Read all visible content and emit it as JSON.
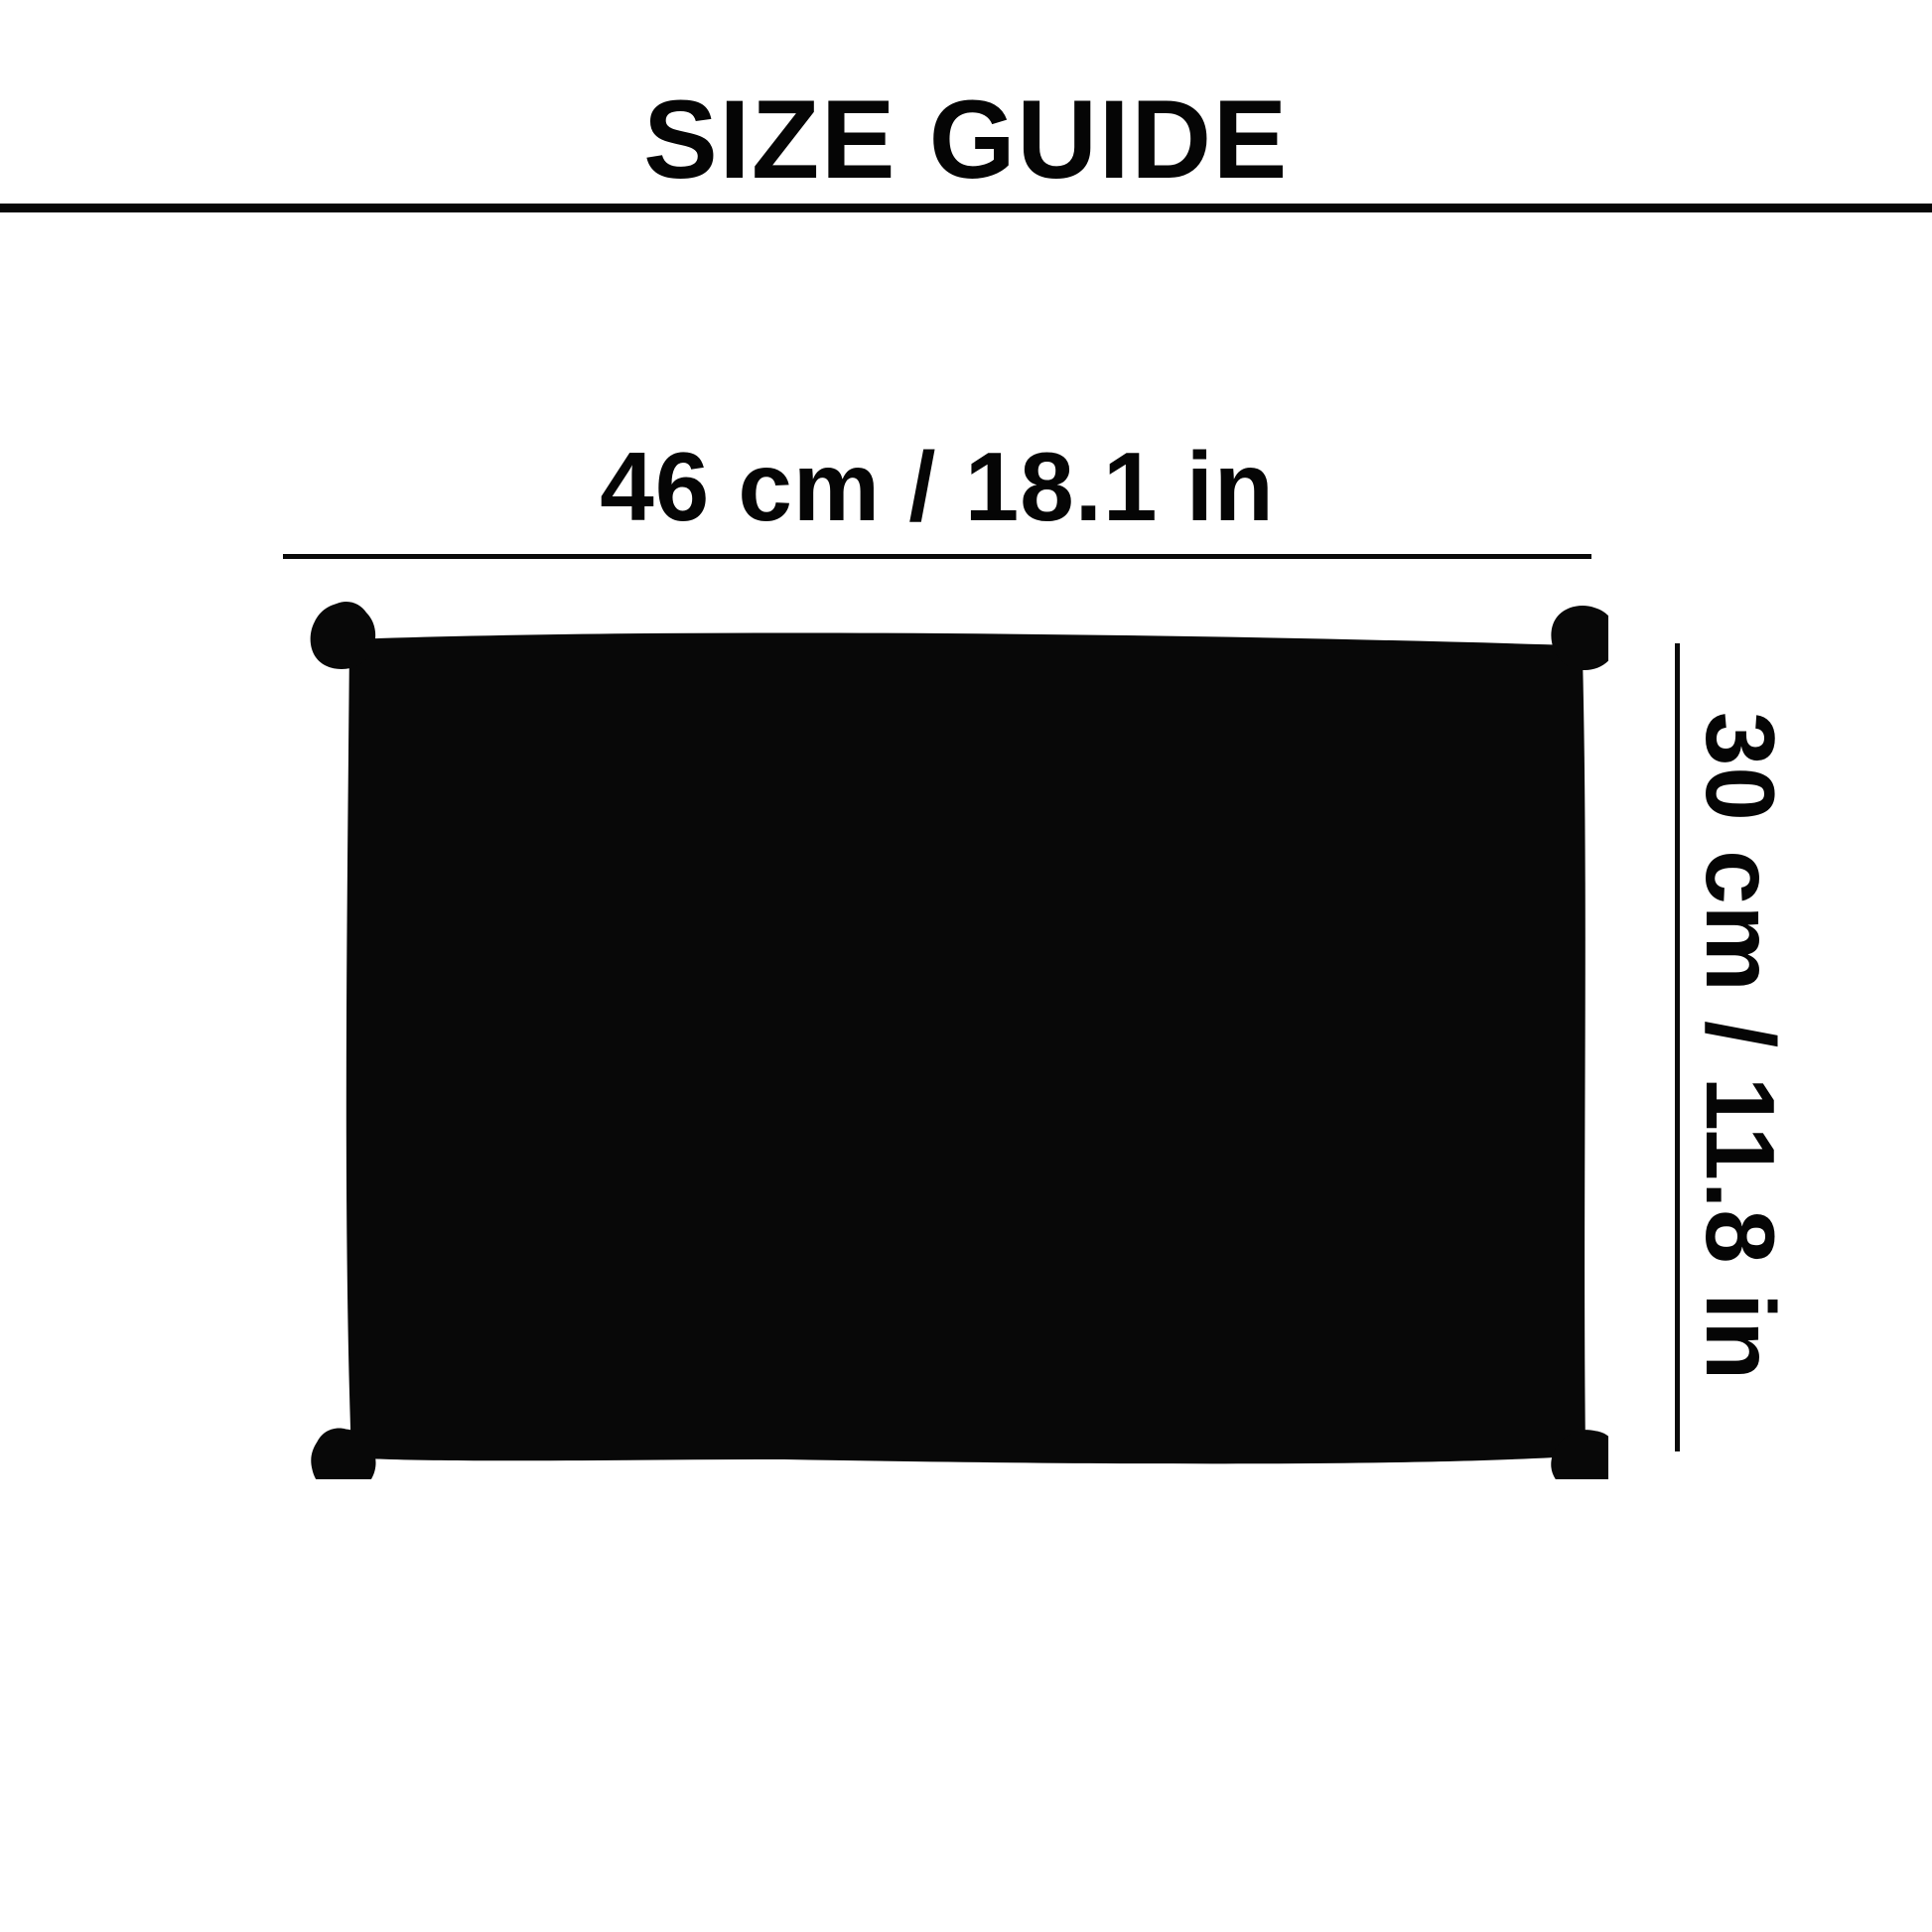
{
  "page": {
    "background_color": "#ffffff",
    "ink_color": "#080808"
  },
  "header": {
    "title": "SIZE GUIDE"
  },
  "size_diagram": {
    "product": "black mat silhouette with corner tabs",
    "width": {
      "label": "46 cm / 18.1 in",
      "cm": 46,
      "in": 18.1
    },
    "height": {
      "label": "30 cm / 11.8 in",
      "cm": 30,
      "in": 11.8
    }
  }
}
